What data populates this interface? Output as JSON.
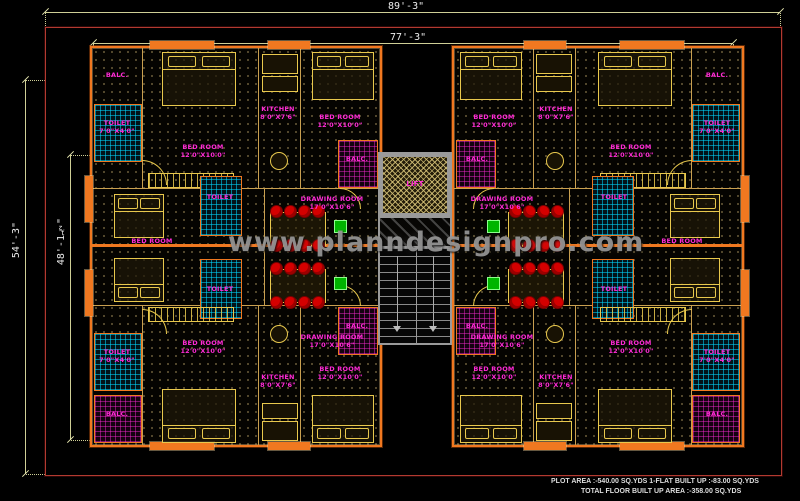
{
  "plan": {
    "watermark": "www.planndesignpro.com",
    "dims": {
      "top_outer": "89'-3\"",
      "top_inner": "77'-3\"",
      "left_outer": "54'-3\"",
      "left_inner": "48'-1½\""
    },
    "rooms": {
      "bed": {
        "label": "BED ROOM",
        "size": "12'0\"X10'0\""
      },
      "drawing": {
        "label": "DRAWING ROOM",
        "size": "17'0\"X10'6\""
      },
      "kitchen": {
        "label": "KITCHEN",
        "size": "8'0\"X7'6\""
      },
      "toilet": {
        "label": "TOILET",
        "size": "7'0\"X4'0\""
      },
      "balc": {
        "label": "BALC."
      },
      "lift": {
        "label": "LIFT"
      }
    },
    "footer": {
      "line1": "PLOT AREA   :-540.00 SQ.YDS  1-FLAT BUILT UP   :-83.00 SQ.YDS",
      "line2": "TOTAL FLOOR BUILT UP AREA   :-358.00 SQ.YDS"
    },
    "colors": {
      "wall": "#f07820",
      "label": "#ff2bd6",
      "dim_line": "#cfcf96",
      "plot_border": "#b23a30",
      "chair": "#d40000",
      "toilet_hatch": "#00d8ff",
      "balc_hatch": "#ff2bd6",
      "lift_wall": "#9a9a9a",
      "watermark": "#9e9e9e"
    }
  }
}
